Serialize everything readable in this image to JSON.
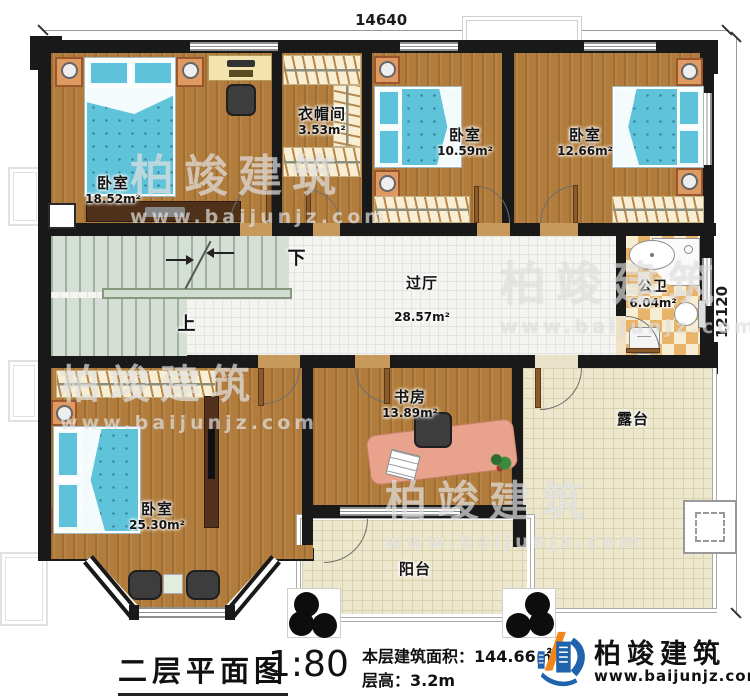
{
  "plan": {
    "dimensions": {
      "top": "14640",
      "right": "12120"
    },
    "rooms": [
      {
        "key": "bedroom-top-left",
        "name": "卧室",
        "area": "18.52m²"
      },
      {
        "key": "cloakroom",
        "name": "衣帽间",
        "area": "3.53m²"
      },
      {
        "key": "bedroom-top-mid",
        "name": "卧室",
        "area": "10.59m²"
      },
      {
        "key": "bedroom-top-right",
        "name": "卧室",
        "area": "12.66m²"
      },
      {
        "key": "hallway",
        "name": "过厅",
        "area": "28.57m²"
      },
      {
        "key": "bathroom",
        "name": "公卫",
        "area": "6.04m²"
      },
      {
        "key": "bedroom-bottom-left",
        "name": "卧室",
        "area": "25.30m²"
      },
      {
        "key": "study",
        "name": "书房",
        "area": "13.89m²"
      },
      {
        "key": "balcony",
        "name": "阳台",
        "area": ""
      },
      {
        "key": "terrace",
        "name": "露台",
        "area": ""
      }
    ],
    "stairs": {
      "down_label": "下",
      "up_label": "上"
    }
  },
  "watermark": {
    "brand": "柏竣建筑",
    "site": "www.baijunjz.com"
  },
  "footer": {
    "title": "二层平面图",
    "scale": "1:80",
    "area_label": "本层建筑面积：",
    "area_value": "144.66㎡",
    "height_label": "层高：",
    "height_value": "3.2m"
  },
  "brand": {
    "name": "柏竣建筑",
    "site": "www.baijunjz.com",
    "blue": "#1e63ac",
    "orange": "#f08519"
  }
}
